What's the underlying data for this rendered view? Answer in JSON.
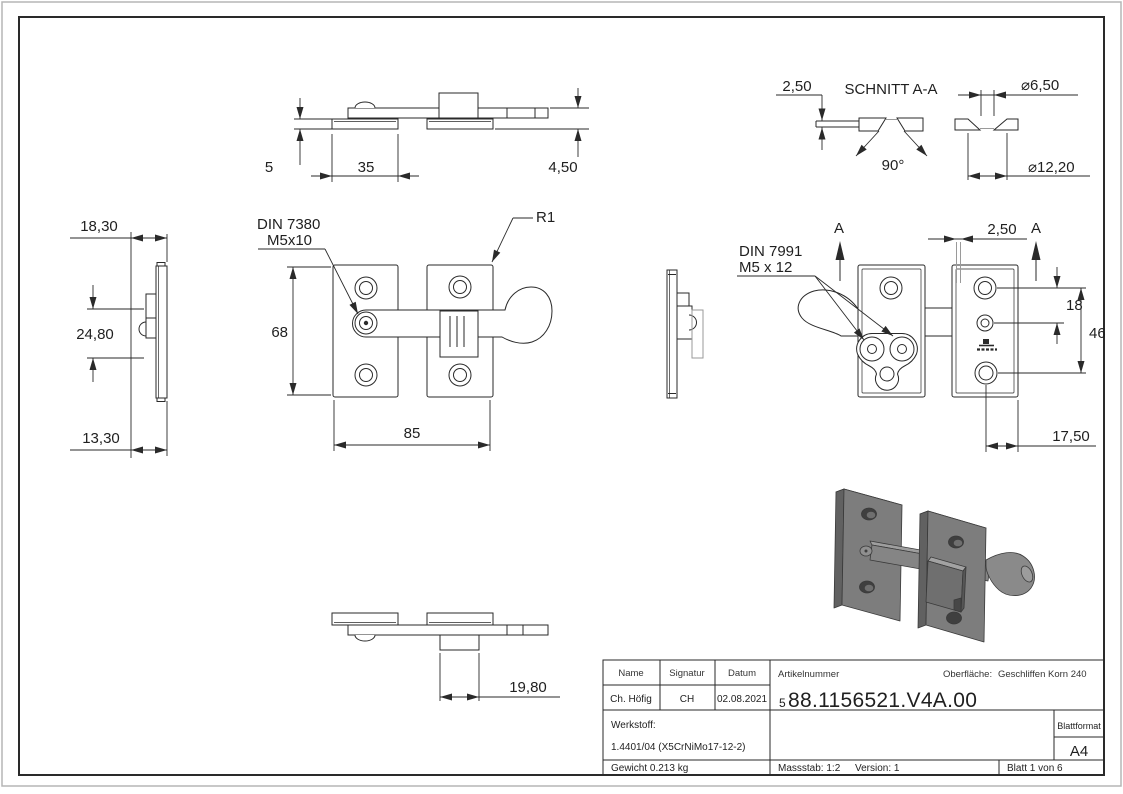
{
  "drawing": {
    "type": "technical-drawing",
    "colors": {
      "line": "#2a2a2a",
      "aux_gray": "#9a9a9a",
      "iso_fill": "#7d7d7d"
    }
  },
  "views": {
    "side_left": {
      "dims": {
        "d1": "18,30",
        "d2": "24,80",
        "d3": "13,30"
      }
    },
    "top": {
      "dims": {
        "d1": "5",
        "d2": "35",
        "d3": "4,50"
      }
    },
    "section": {
      "title": "SCHNITT A-A",
      "dims": {
        "thickness": "2,50",
        "angle": "90°",
        "dia_small": "⌀6,50",
        "dia_large": "⌀12,20"
      }
    },
    "front": {
      "labels": {
        "din": "DIN 7380",
        "thread": "M5x10",
        "radius": "R1"
      },
      "dims": {
        "height": "68",
        "width": "85"
      }
    },
    "back": {
      "labels": {
        "din": "DIN 7991",
        "thread": "M5 x 12",
        "section_left": "A",
        "section_right": "A"
      },
      "dims": {
        "gap": "2,50",
        "hole_spacing": "18",
        "hole_span": "46",
        "offset": "17,50"
      }
    },
    "bottom": {
      "dims": {
        "depth": "19,80"
      }
    }
  },
  "title_block": {
    "headers": {
      "name": "Name",
      "signatur": "Signatur",
      "datum": "Datum"
    },
    "values": {
      "name": "Ch. Höfig",
      "signatur": "CH",
      "datum": "02.08.2021"
    },
    "artikelnummer_label": "Artikelnummer",
    "artikelnummer_prefix": "5",
    "artikelnummer": "88.1156521.V4A.00",
    "oberflaeche_label": "Oberfläche:",
    "oberflaeche": "Geschliffen Korn 240",
    "werkstoff_label": "Werkstoff:",
    "werkstoff": "1.4401/04 (X5CrNiMo17-12-2)",
    "blattformat_label": "Blattformat",
    "blattformat": "A4",
    "gewicht": "Gewicht 0.213 kg",
    "massstab": "Massstab: 1:2",
    "version": "Version: 1",
    "blatt": "Blatt 1 von 6"
  }
}
